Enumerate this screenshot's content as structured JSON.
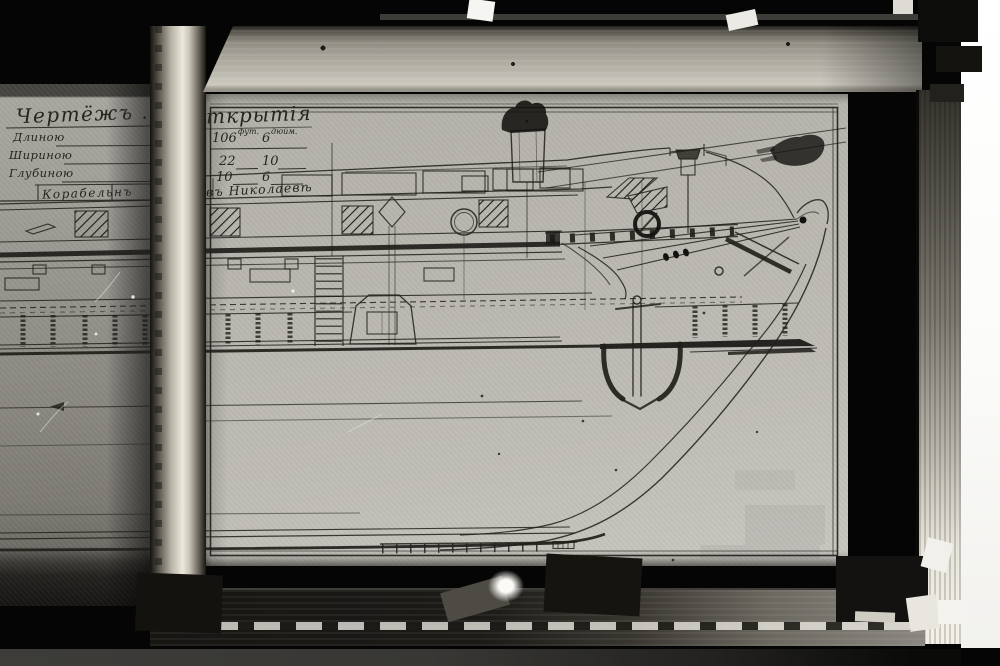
{
  "title_block": {
    "title_left": "Чертёжъ . Ш",
    "title_right": "ткрытія",
    "dims": [
      {
        "label": "Длиною",
        "v1": "106",
        "u1": "фут.",
        "v2": "6",
        "u2": "дюйм."
      },
      {
        "label": "Шириною",
        "v1": "22",
        "v2": "10"
      },
      {
        "label": "Глубиною",
        "v1": "10",
        "v2": "6"
      }
    ],
    "builder_left": "Корабельнъ",
    "builder_right": "въ Николаевѣ"
  },
  "scale_bar": {
    "tick_count": 12,
    "end_box_cells": 4
  },
  "colors": {
    "background": "#060606",
    "paper_main": "#b8b6af",
    "paper_left": "#96948e",
    "frame_bright": "#ece8dc",
    "frame_dark": "#1c1a17",
    "ink": "#201e1a",
    "photo_margin": "#ffffff"
  }
}
